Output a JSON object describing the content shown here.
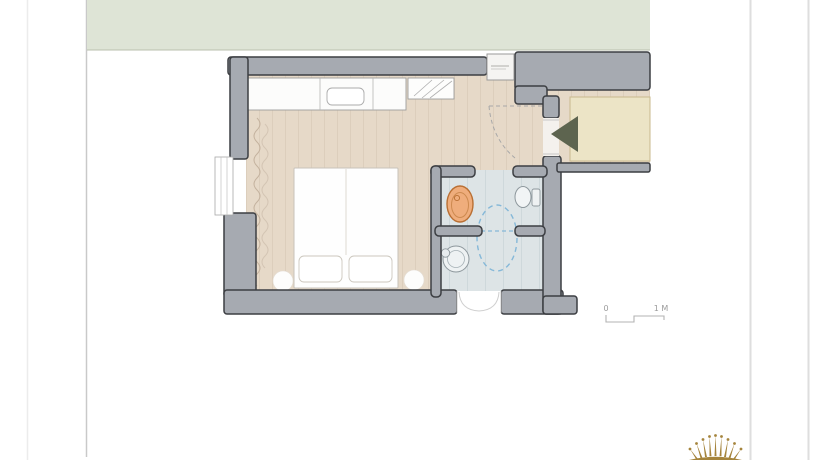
{
  "floor_plan": {
    "scale_bar": {
      "left_label": "0",
      "right_label": "1 M"
    }
  },
  "colors": {
    "exterior_green": "#dee4d6",
    "exterior_edge": "#b9bfae",
    "wall_gray": "#a6aab1",
    "wall_outline": "#3c3e42",
    "wood_floor": "#e6d9c8",
    "plank_line": "#d7c7b4",
    "bathroom_floor": "#dde4e6",
    "tile_line": "#c6d1d5",
    "corridor_mat": "#ece4c6",
    "corridor_mat_edge": "#c9b98e",
    "fixture_orange": "#efad7c",
    "fixture_orange_edge": "#b96f33",
    "door_swing_blue": "#85b8d8",
    "entrance_arrow": "#5d644f",
    "scale_text": "#9b9b9b",
    "crown_gold": "#a5843c"
  },
  "icons": {
    "entrance_arrow": "solid-triangle-pointing-left",
    "crown_logo": "gold-crown"
  }
}
